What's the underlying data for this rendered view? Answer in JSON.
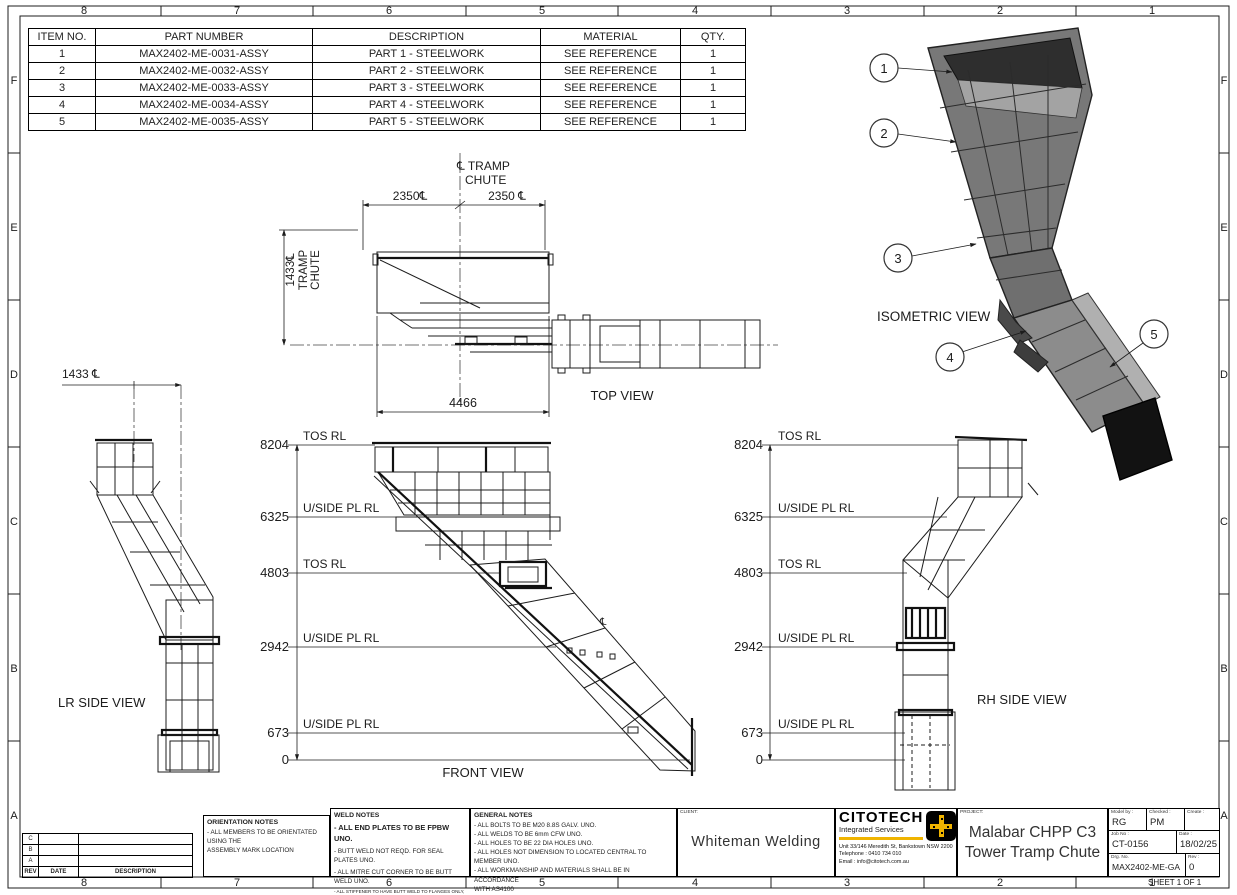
{
  "sheet": {
    "sheet_label": "SHEET 1 OF 1"
  },
  "zones": {
    "cols": [
      "8",
      "7",
      "6",
      "5",
      "4",
      "3",
      "2",
      "1"
    ],
    "rows": [
      "F",
      "E",
      "D",
      "C",
      "B",
      "A"
    ]
  },
  "bom": {
    "headers": [
      "ITEM NO.",
      "PART NUMBER",
      "DESCRIPTION",
      "MATERIAL",
      "QTY."
    ],
    "rows": [
      [
        "1",
        "MAX2402-ME-0031-ASSY",
        "PART 1 - STEELWORK",
        "SEE REFERENCE",
        "1"
      ],
      [
        "2",
        "MAX2402-ME-0032-ASSY",
        "PART 2 - STEELWORK",
        "SEE REFERENCE",
        "1"
      ],
      [
        "3",
        "MAX2402-ME-0033-ASSY",
        "PART 3 - STEELWORK",
        "SEE REFERENCE",
        "1"
      ],
      [
        "4",
        "MAX2402-ME-0034-ASSY",
        "PART 4 - STEELWORK",
        "SEE REFERENCE",
        "1"
      ],
      [
        "5",
        "MAX2402-ME-0035-ASSY",
        "PART 5 - STEELWORK",
        "SEE REFERENCE",
        "1"
      ]
    ]
  },
  "top_view": {
    "label": "TOP VIEW",
    "cl_line1": "℄ TRAMP",
    "cl_line2": "CHUTE",
    "dim_left": "2350℄",
    "dim_right": "2350 ℄",
    "dim_width": "4466",
    "side_dim_value": "1433℄",
    "side_dim_l1": "TRAMP",
    "side_dim_l2": "CHUTE"
  },
  "front_view": {
    "label": "FRONT VIEW",
    "cl_symbol": "℄",
    "levels": [
      {
        "rl": "8204",
        "name": "TOS RL"
      },
      {
        "rl": "6325",
        "name": "U/SIDE PL RL"
      },
      {
        "rl": "4803",
        "name": "TOS RL"
      },
      {
        "rl": "2942",
        "name": "U/SIDE PL RL"
      },
      {
        "rl": "673",
        "name": "U/SIDE PL RL"
      },
      {
        "rl": "0",
        "name": ""
      }
    ]
  },
  "lr_side_view": {
    "label": "LR SIDE VIEW",
    "dim": "1433 ℄"
  },
  "rh_side_view": {
    "label": "RH SIDE VIEW",
    "levels": [
      {
        "rl": "8204",
        "name": "TOS RL"
      },
      {
        "rl": "6325",
        "name": "U/SIDE PL RL"
      },
      {
        "rl": "4803",
        "name": "TOS RL"
      },
      {
        "rl": "2942",
        "name": "U/SIDE PL RL"
      },
      {
        "rl": "673",
        "name": "U/SIDE PL RL"
      },
      {
        "rl": "0",
        "name": ""
      }
    ]
  },
  "isometric_view": {
    "label": "ISOMETRIC VIEW",
    "balloons": [
      "1",
      "2",
      "3",
      "4",
      "5"
    ]
  },
  "revision_table": {
    "row_labels": [
      "C",
      "B",
      "A"
    ],
    "headers": [
      "REV",
      "DATE",
      "DESCRIPTION"
    ]
  },
  "orientation_notes": {
    "title": "ORIENTATION NOTES",
    "lines": [
      "- ALL MEMBERS TO BE ORIENTATED USING THE",
      "  ASSEMBLY MARK LOCATION"
    ]
  },
  "weld_notes": {
    "title": "WELD NOTES",
    "line_big": "- ALL END PLATES TO BE FPBW UNO.",
    "lines": [
      "- BUTT WELD NOT REQD. FOR SEAL PLATES UNO.",
      "- ALL  MITRE CUT CORNER TO BE BUTT WELD UNO."
    ],
    "line_tiny1": "- ALL STIFFENER TO HAVE BUTT WELD TO FLANGES ONLY,",
    "line_tiny2": "  FILLET WELD TO WEB",
    "line_last": "- ALL  SHOP SPLICE TO BE FSBW UNO."
  },
  "general_notes": {
    "title": "GENERAL NOTES",
    "lines": [
      "- ALL BOLTS TO BE M20 8.8S GALV. UNO.",
      "- ALL WELDS TO BE 6mm CFW UNO.",
      "- ALL HOLES TO BE 22 DIA HOLES UNO.",
      "- ALL HOLES NOT DIMENSION TO LOCATED CENTRAL TO MEMBER UNO.",
      "- ALL WORKMANSHIP AND MATERIALS SHALL BE IN ACCORDANCE",
      "  WITH AS4100"
    ]
  },
  "client": {
    "label": "CLIENT:",
    "name": "Whiteman Welding"
  },
  "company": {
    "name": "CITOTECH",
    "tagline": "Integrated Services",
    "address": "Unit 33/146 Meredith St, Bankstown NSW 2200",
    "phone": "Telephone : 0410 734 010",
    "email": "Email : info@citotech.com.au",
    "accent_color": "#f0b400"
  },
  "title_block": {
    "project_label": "PROJECT:",
    "project_line1": "Malabar CHPP C3",
    "project_line2": "Tower Tramp Chute",
    "model_by_label": "Model by :",
    "model_by": "RG",
    "checked_label": "Checked :",
    "checked": "PM",
    "create_label": "Create :",
    "create": "",
    "job_no_label": "Job No :",
    "job_no": "CT-0156",
    "date_label": "Date :",
    "date": "18/02/25",
    "drg_no_label": "Drg. No.",
    "drg_no": "MAX2402-ME-GA",
    "rev_label": "Rev :",
    "rev": "0"
  }
}
